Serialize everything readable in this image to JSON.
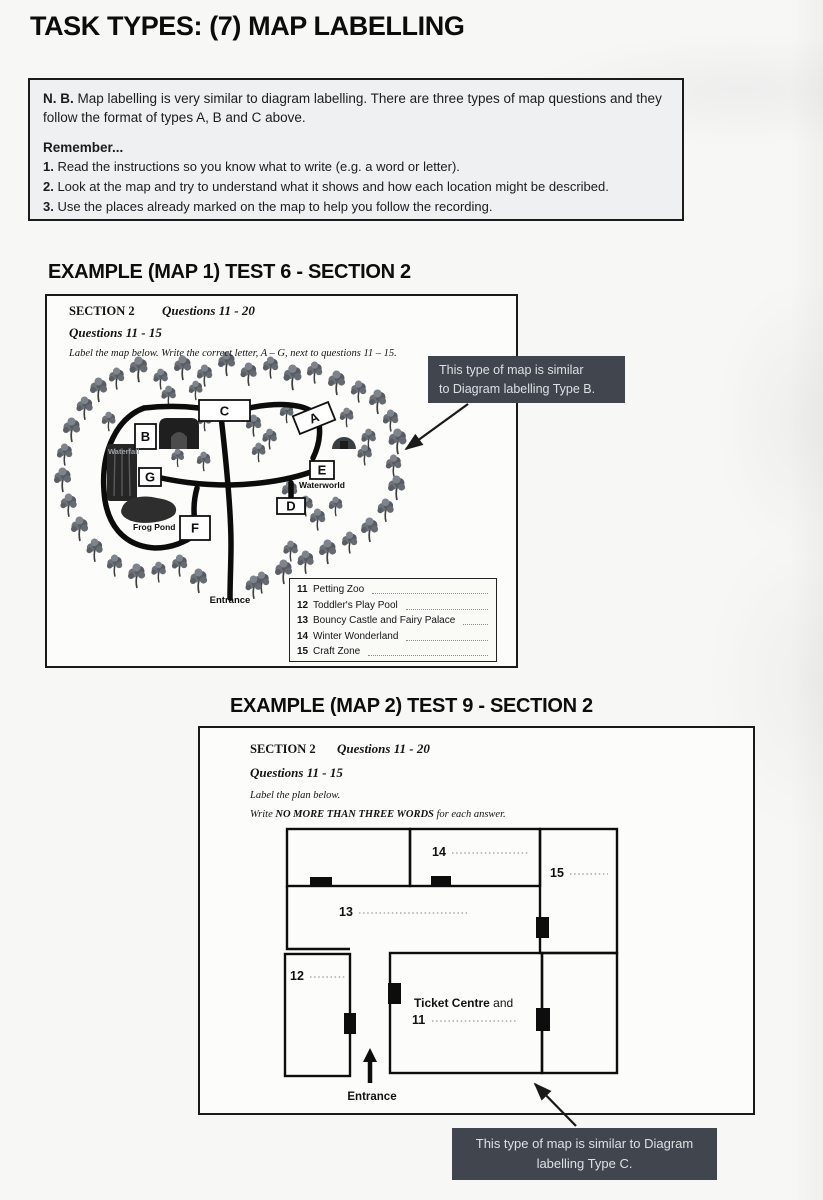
{
  "page": {
    "title": "TASK TYPES: (7) MAP LABELLING"
  },
  "nb_box": {
    "nb_label": "N. B.",
    "nb_text": " Map labelling is very similar to diagram labelling. There are three types of map questions and they follow the format of types A, B and C above.",
    "remember_heading": "Remember...",
    "items": [
      {
        "num": "1.",
        "text": " Read the instructions so you know what to write (e.g. a word or letter)."
      },
      {
        "num": "2.",
        "text": " Look at the map and try to understand what it shows and how each location might be described."
      },
      {
        "num": "3.",
        "text": " Use the places already marked on the map to help you follow the recording."
      }
    ]
  },
  "example1": {
    "heading": "EXAMPLE (MAP 1) TEST 6 - SECTION 2",
    "section_label": "SECTION 2",
    "questions_range": "Questions 11 - 20",
    "sub_range": "Questions 11 - 15",
    "instruction": "Label the map below. Write the correct letter, A –  G, next to questions 11 – 15.",
    "map": {
      "letters": [
        "A",
        "B",
        "C",
        "D",
        "E",
        "F",
        "G"
      ],
      "places": {
        "waterfall": "Waterfall",
        "waterworld": "Waterworld",
        "frog_pond": "Frog Pond",
        "entrance": "Entrance"
      }
    },
    "questions": [
      {
        "num": "11",
        "text": "Petting Zoo"
      },
      {
        "num": "12",
        "text": "Toddler's Play Pool"
      },
      {
        "num": "13",
        "text": "Bouncy Castle and Fairy Palace"
      },
      {
        "num": "14",
        "text": "Winter Wonderland"
      },
      {
        "num": "15",
        "text": "Craft Zone"
      }
    ],
    "callout": {
      "line1": "This type of map is similar",
      "line2": "to Diagram labelling Type B."
    }
  },
  "example2": {
    "heading": "EXAMPLE (MAP 2) TEST 9 - SECTION 2",
    "section_label": "SECTION 2",
    "questions_range": "Questions 11 - 20",
    "sub_range": "Questions 11 - 15",
    "instruction1": "Label the plan below.",
    "instruction2_prefix": "Write ",
    "instruction2_bold": "NO MORE THAN THREE WORDS",
    "instruction2_suffix": " for each answer.",
    "plan": {
      "room_labels": {
        "r11": "11",
        "r12": "12",
        "r13": "13",
        "r14": "14",
        "r15": "15"
      },
      "ticket_centre_bold": "Ticket Centre",
      "ticket_centre_rest": " and",
      "entrance": "Entrance"
    },
    "callout": {
      "line1": "This type of map is similar to Diagram",
      "line2": "labelling Type C."
    }
  },
  "colors": {
    "callout_bg": "#41454e",
    "callout_text": "#dde0e2",
    "ink": "#141414"
  }
}
